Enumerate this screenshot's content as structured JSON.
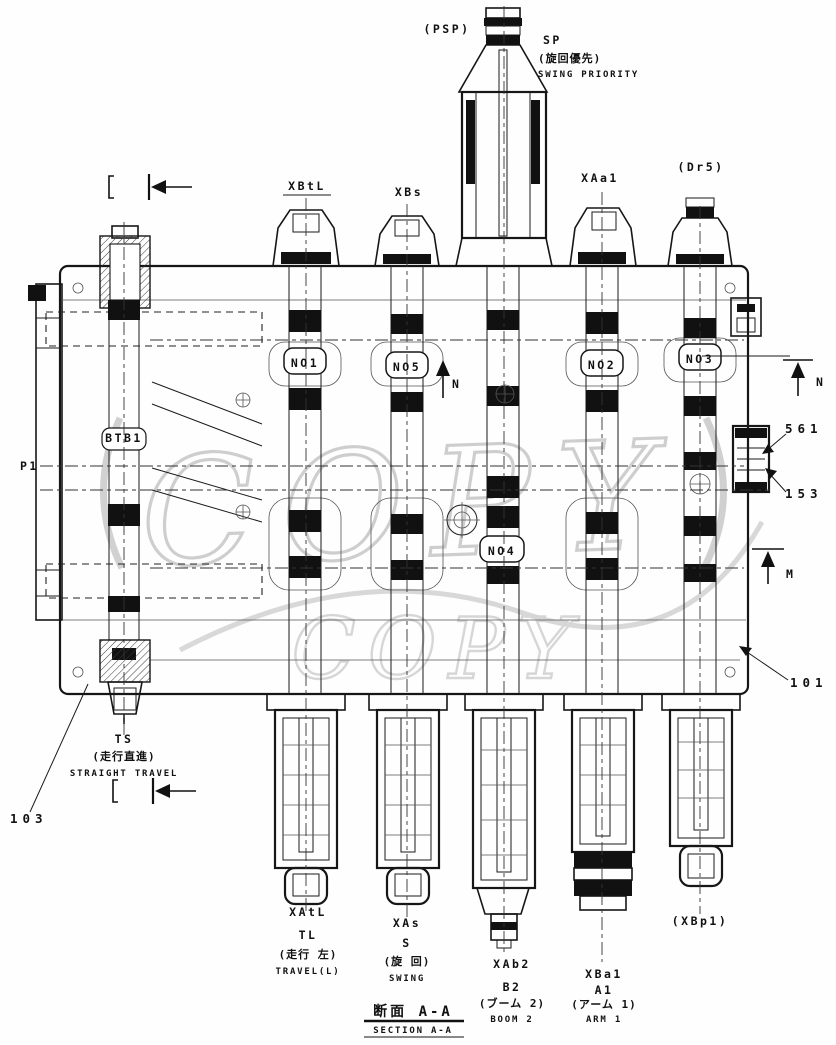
{
  "drawing": {
    "kind": "hydraulic-control-valve-cross-section",
    "colors": {
      "ink": "#161616",
      "watermark": "#c9c9c9",
      "paper": "#fefefe"
    },
    "watermark": "COPY",
    "section": {
      "jp": "断面 A-A",
      "en": "SECTION A-A"
    },
    "top": {
      "psp": "(PSP)",
      "sp": "SP",
      "sp_jp": "(旋回優先)",
      "sp_en": "SWING PRIORITY",
      "ports": [
        {
          "label": "XBtL"
        },
        {
          "label": "XBs"
        },
        {
          "label": "XAa1"
        },
        {
          "label": "(Dr5)"
        }
      ]
    },
    "left": {
      "p1": "P1",
      "stamp": "BTB1",
      "ts": "TS",
      "ts_jp": "(走行直進)",
      "ts_en": "STRAIGHT TRAVEL",
      "ref103": "103"
    },
    "center": {
      "no1": "NO1",
      "no5": "NO5",
      "no2": "NO2",
      "no3": "NO3",
      "no4": "NO4",
      "n": "N",
      "m": "M"
    },
    "right": {
      "ref561": "561",
      "ref153": "153",
      "ref101": "101"
    },
    "bottom": {
      "groups": [
        {
          "pilot": "XAtL",
          "port": "TL",
          "jp": "(走行 左)",
          "en": "TRAVEL(L)"
        },
        {
          "pilot": "XAs",
          "port": "S",
          "jp": "(旋 回)",
          "en": "SWING"
        },
        {
          "pilot": "XAb2",
          "port": "B2",
          "jp": "(ブーム 2)",
          "en": "BOOM 2"
        },
        {
          "pilot": "XBa1",
          "port": "A1",
          "jp": "(アーム 1)",
          "en": "ARM 1"
        },
        {
          "pilot": "(XBp1)"
        }
      ]
    }
  }
}
